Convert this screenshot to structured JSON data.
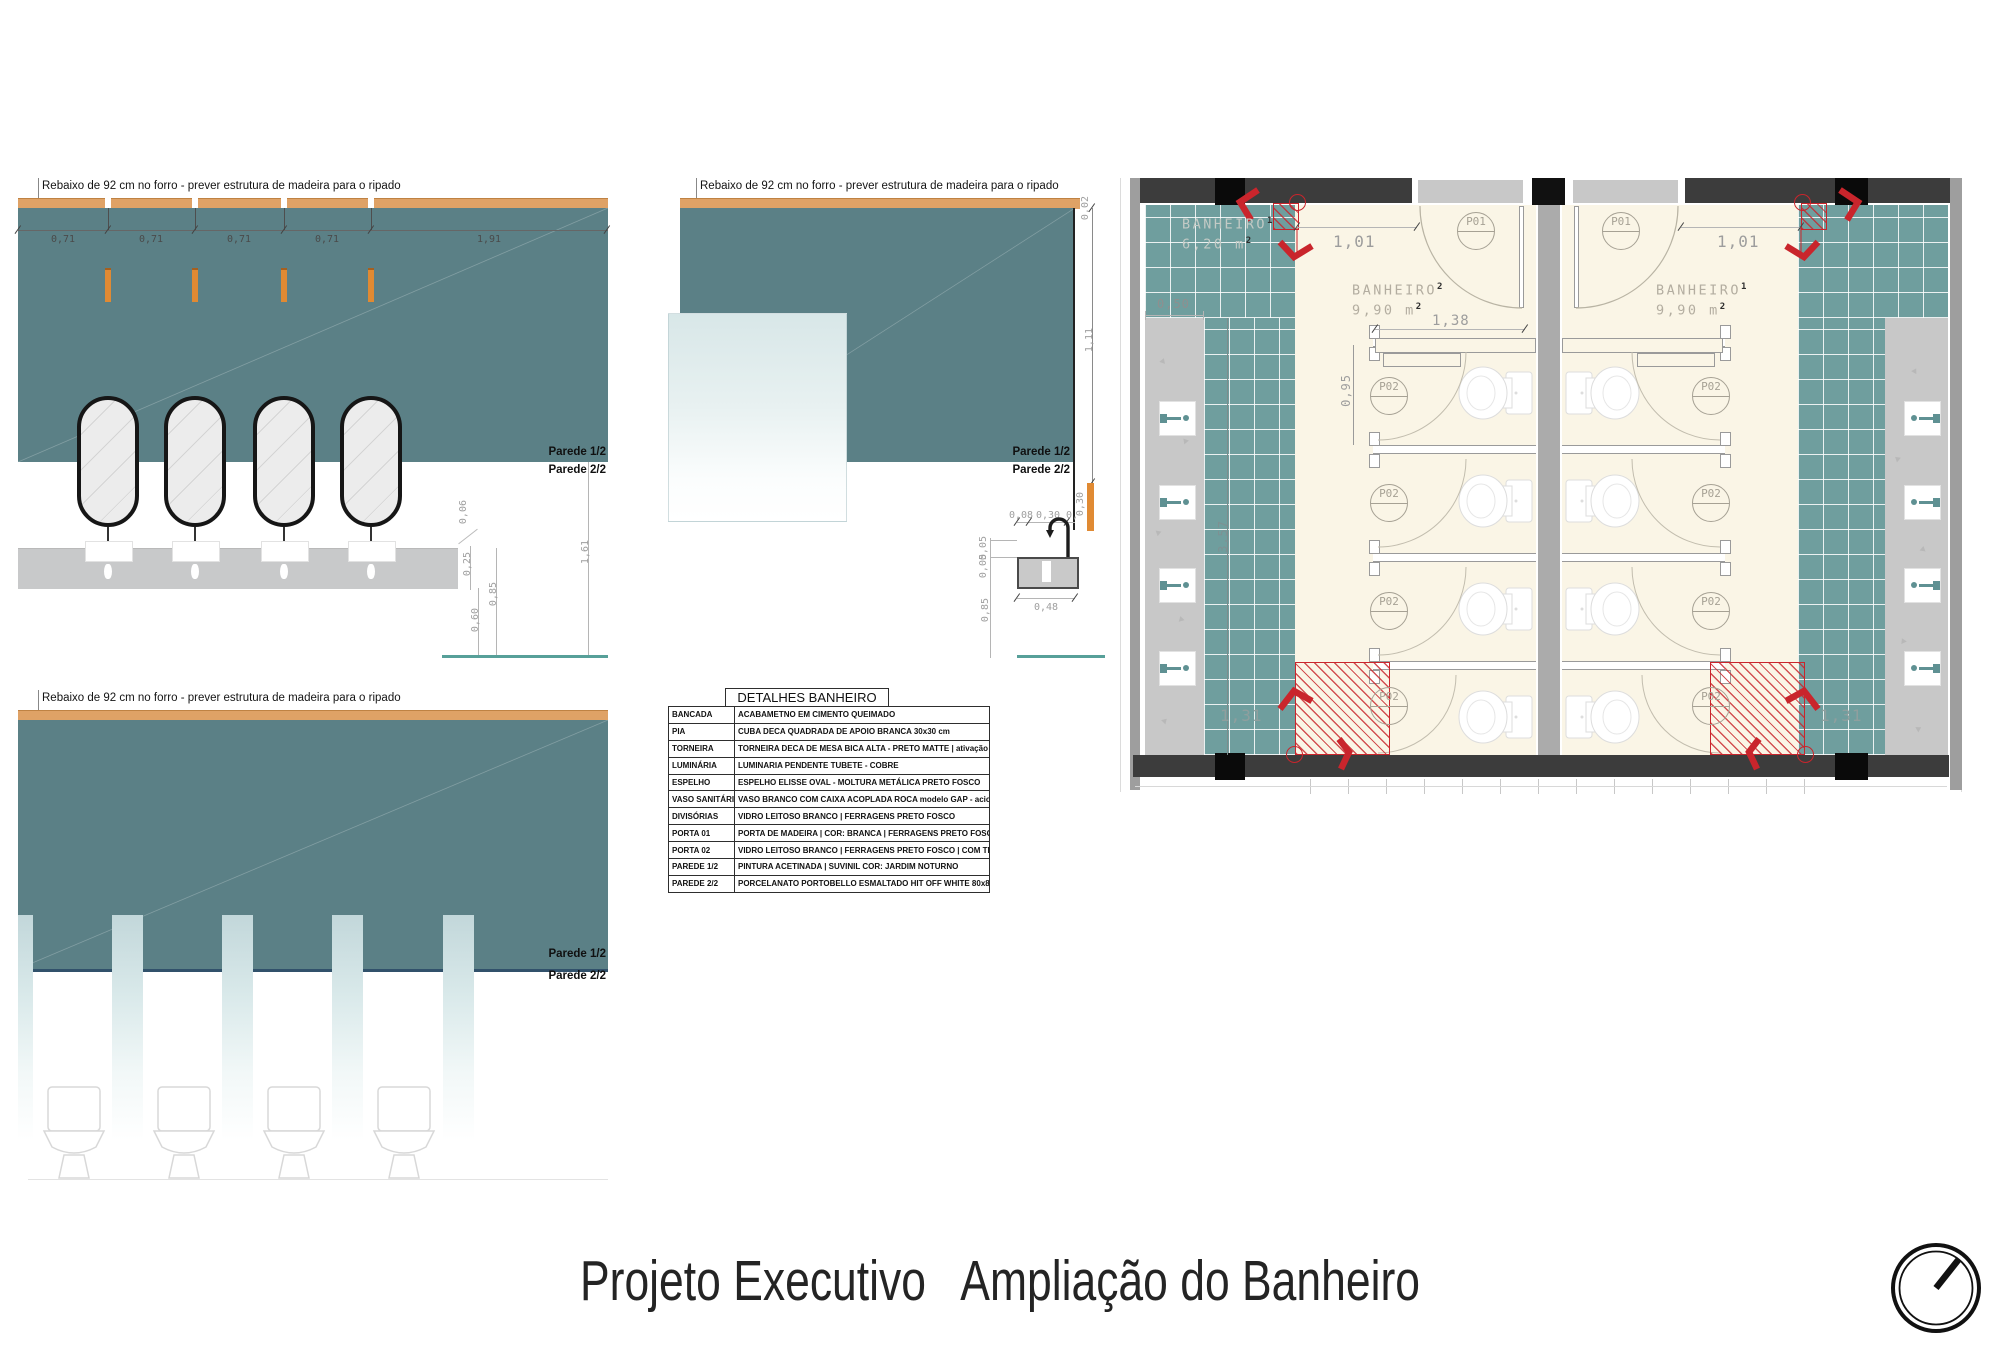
{
  "footer": {
    "title_left": "Projeto Executivo",
    "title_right": "Ampliação do Banheiro"
  },
  "elevations": {
    "note": "Rebaixo de 92 cm no forro - prever estrutura de madeira para o ripado",
    "parede1": "Parede 1/2",
    "parede2": "Parede 2/2",
    "elev1_top_dims": [
      "0,71",
      "0,71",
      "0,71",
      "0,71",
      "1,91"
    ],
    "elev1_side_dims": {
      "d006": "0,06",
      "d025": "0,25",
      "d085": "0,85",
      "d060": "0,60",
      "d161": "1,61"
    },
    "elev2_side_dims": {
      "d002": "0,02",
      "d111": "1,11",
      "d030": "0,30"
    },
    "elev2_sink_dims": {
      "d008": "0,08",
      "d030": "0,30",
      "dcut": "0,0",
      "d005a": "0,05",
      "d005b": "0,05",
      "d085": "0,85",
      "d048": "0,48"
    }
  },
  "plan": {
    "rooms": [
      {
        "name": "BANHEIRO",
        "sup": "1",
        "area": "6,20 m",
        "area_sup": "2"
      },
      {
        "name": "BANHEIRO",
        "sup": "2",
        "area": "9,90 m",
        "area_sup": "2"
      },
      {
        "name": "BANHEIRO",
        "sup": "1",
        "area": "9,90 m",
        "area_sup": "2"
      }
    ],
    "door_tags": {
      "p01": "P01",
      "p02": "P02"
    },
    "dims": {
      "d101": "1,01",
      "d138": "1,38",
      "d095": "0,95",
      "d050": "0,50",
      "d357": "3,57",
      "d131": "1,31"
    }
  },
  "detail_table": {
    "title": "DETALHES BANHEIRO",
    "rows": [
      [
        "BANCADA",
        "ACABAMETNO EM CIMENTO QUEIMADO"
      ],
      [
        "PIA",
        "CUBA DECA QUADRADA DE APOIO BRANCA 30x30 cm"
      ],
      [
        "TORNEIRA",
        "TORNEIRA DECA DE MESA BICA ALTA - PRETO MATTE | ativação por sensor"
      ],
      [
        "LUMINÁRIA",
        "LUMINARIA PENDENTE TUBETE - COBRE"
      ],
      [
        "ESPELHO",
        "ESPELHO ELISSE OVAL - MOLTURA METÁLICA PRETO FOSCO"
      ],
      [
        "VASO SANITÁRIO",
        "VASO BRANCO COM CAIXA ACOPLADA ROCA modelo GAP - acionamento duplo 3/6 L"
      ],
      [
        "DIVISÓRIAS",
        "VIDRO LEITOSO BRANCO | FERRAGENS PRETO FOSCO"
      ],
      [
        "PORTA 01",
        "PORTA DE MADEIRA | COR: BRANCA | FERRAGENS PRETO FOSCO"
      ],
      [
        "PORTA 02",
        "VIDRO LEITOSO BRANCO | FERRAGENS PRETO FOSCO | COM TRANCA"
      ],
      [
        "PAREDE 1/2",
        "PINTURA ACETINADA | SUVINIL COR: JARDIM NOTURNO"
      ],
      [
        "PAREDE 2/2",
        "PORCELANATO PORTOBELLO ESMALTADO HIT OFF WHITE 80x80 cm"
      ]
    ]
  },
  "colors": {
    "teal_wall": "#5b8086",
    "teal_tile": "#6f9e9e",
    "wood": "#dfa266",
    "pendant": "#e08a33",
    "red": "#c9252c",
    "cream": "#faf5e6"
  }
}
